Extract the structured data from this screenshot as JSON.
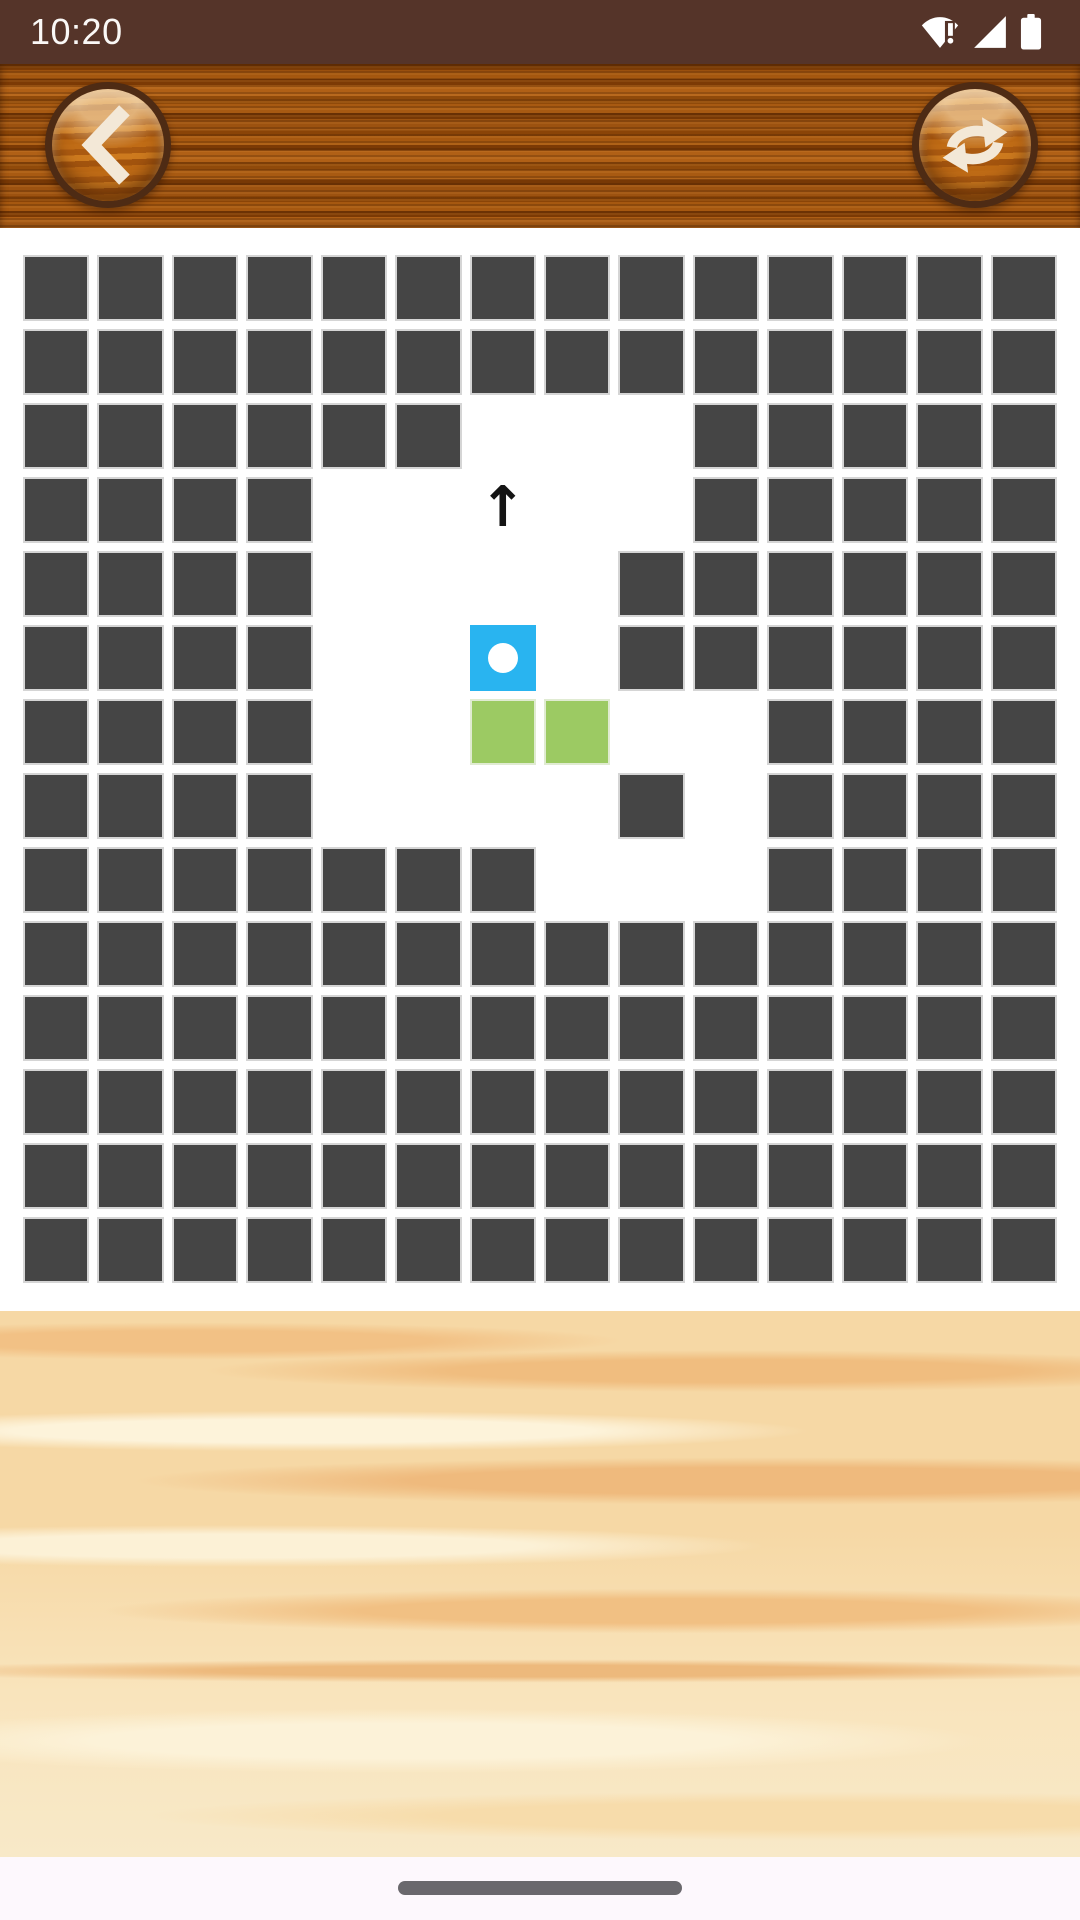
{
  "status_bar": {
    "time": "10:20",
    "icons": [
      {
        "name": "wifi-alert-icon"
      },
      {
        "name": "cellular-signal-icon"
      },
      {
        "name": "battery-icon"
      }
    ]
  },
  "header": {
    "back_button_label": "back",
    "restart_button_label": "restart",
    "back_icon": "chevron-left-icon",
    "restart_icon": "refresh-arrows-icon"
  },
  "board": {
    "rows": 14,
    "cols": 14,
    "cell_legend": {
      "D": "wall",
      "W": "open",
      "B": "player-ball",
      "G": "goal",
      "A": "arrow-up-hint"
    },
    "cells": [
      "DDDDDDDDDDDDDD",
      "DDDDDDDDDDDDDD",
      "DDDDDDWWWDDDDD",
      "DDDDWWAWWDDDDD",
      "DDDDWWWWDDDDDD",
      "DDDDWWBWDDDDDD",
      "DDDDWWGGWWDDDD",
      "DDDDWWWWDWDDDD",
      "DDDDDDDWWWDDDD",
      "DDDDDDDDDDDDDD",
      "DDDDDDDDDDDDDD",
      "DDDDDDDDDDDDDD",
      "DDDDDDDDDDDDDD",
      "DDDDDDDDDDDDDD"
    ],
    "arrow_glyph": "↑",
    "colors": {
      "wall": "#454545",
      "wall_border": "#d5d5d5",
      "player": "#29b4f0",
      "player_dot": "#ffffff",
      "goal": "#9cca63",
      "goal_border": "#e0ebd2",
      "board_bg": "#ffffff"
    }
  },
  "theme": {
    "status_bar_bg": "#553429",
    "nav_bar_bg": "#fdf8fd",
    "gesture_pill_color": "#6a686d"
  }
}
